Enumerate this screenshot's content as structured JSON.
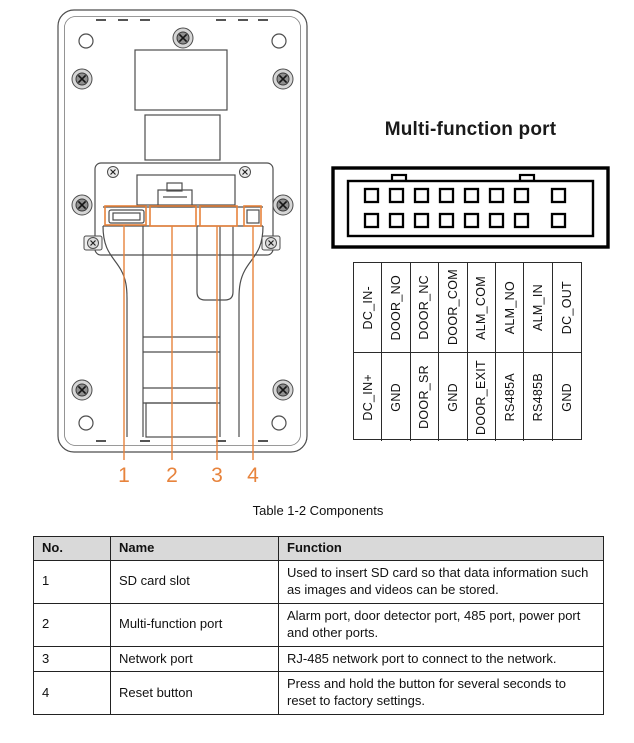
{
  "device_diagram": {
    "callouts": [
      "1",
      "2",
      "3",
      "4"
    ]
  },
  "multi_function_port": {
    "title": "Multi-function port",
    "pins": {
      "top_row": [
        "DC_IN-",
        "DOOR_NO",
        "DOOR_NC",
        "DOOR_COM",
        "ALM_COM",
        "ALM_NO",
        "ALM_IN",
        "DC_OUT"
      ],
      "bottom_row": [
        "DC_IN+",
        "GND",
        "DOOR_SR",
        "GND",
        "DOOR_EXIT",
        "RS485A",
        "RS485B",
        "GND"
      ]
    }
  },
  "table_caption": "Table 1-2 Components",
  "components_table": {
    "headers": [
      "No.",
      "Name",
      "Function"
    ],
    "rows": [
      {
        "no": "1",
        "name": "SD card slot",
        "function": "Used to insert SD card so that data information such as images and videos can be stored."
      },
      {
        "no": "2",
        "name": "Multi-function port",
        "function": "Alarm port, door detector port, 485 port, power port and other ports."
      },
      {
        "no": "3",
        "name": "Network port",
        "function": "RJ-485 network port to connect to the network."
      },
      {
        "no": "4",
        "name": "Reset button",
        "function": "Press and hold the button for several seconds to reset to factory settings."
      }
    ]
  },
  "colors": {
    "accent_orange": "#E7833C",
    "table_header_bg": "#D9D9D9",
    "line_gray": "#4D4D4D",
    "connector_black": "#000000"
  }
}
